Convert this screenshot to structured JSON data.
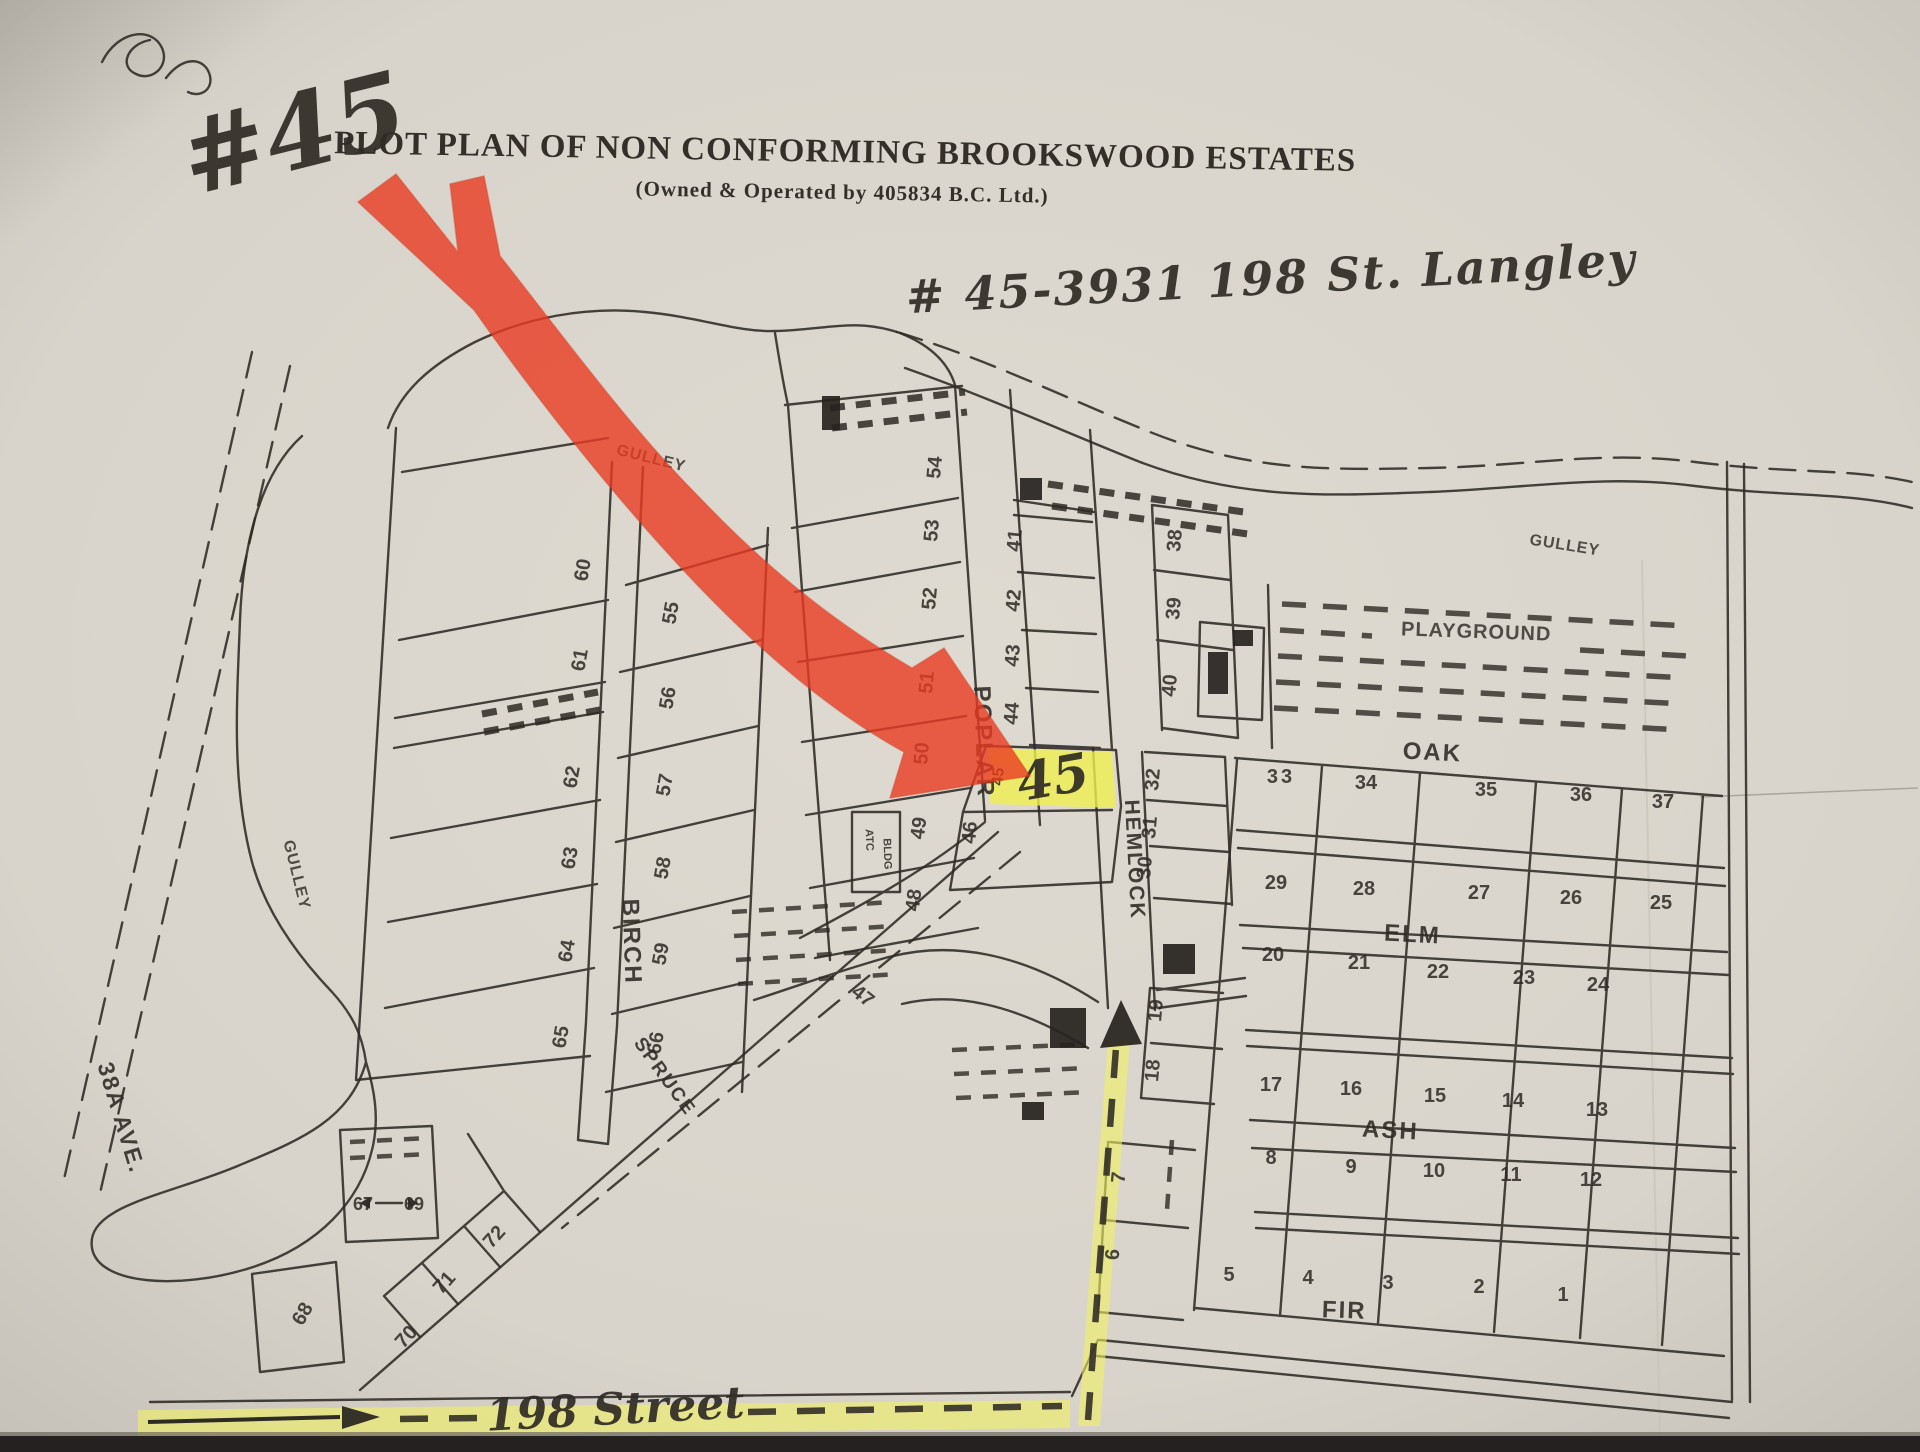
{
  "page": {
    "title": "PLOT PLAN OF NON CONFORMING BROOKSWOOD ESTATES",
    "subtitle": "(Owned & Operated by 405834 B.C. Ltd.)"
  },
  "annotations": {
    "unit": "#45",
    "address": "# 45-3931 198 St. Langley",
    "street_label": "198 Street",
    "lot45_handwritten": "45"
  },
  "colors": {
    "paper": "#d9d5cc",
    "ink": "#2e2a24",
    "highlight_arrow_red": "#ea3b22",
    "highlight_yellow": "#f0ef55"
  },
  "map": {
    "streets": [
      {
        "t": "POPLAR",
        "x": 976,
        "y": 742,
        "r": 88,
        "s": 24
      },
      {
        "t": "HEMLOCK",
        "x": 1128,
        "y": 860,
        "r": 87,
        "s": 21
      },
      {
        "t": "BIRCH",
        "x": 624,
        "y": 942,
        "r": 88,
        "s": 24
      },
      {
        "t": "OAK",
        "x": 1432,
        "y": 760,
        "r": 3,
        "s": 24,
        "ls": 3
      },
      {
        "t": "ELM",
        "x": 1412,
        "y": 942,
        "r": 3,
        "s": 24,
        "ls": 3
      },
      {
        "t": "ASH",
        "x": 1390,
        "y": 1138,
        "r": 3,
        "s": 24,
        "ls": 2
      },
      {
        "t": "FIR",
        "x": 1344,
        "y": 1318,
        "r": 2,
        "s": 24,
        "ls": 2
      },
      {
        "t": "SPRUCE",
        "x": 660,
        "y": 1080,
        "r": 54,
        "s": 19
      },
      {
        "t": "38A AVE.",
        "x": 114,
        "y": 1120,
        "r": 73,
        "s": 23
      }
    ],
    "areas": [
      {
        "t": "GULLEY",
        "x": 650,
        "y": 463,
        "r": 14,
        "s": 16,
        "ls": 2
      },
      {
        "t": "GULLEY",
        "x": 1564,
        "y": 550,
        "r": 9,
        "s": 16,
        "ls": 2
      },
      {
        "t": "GULLEY",
        "x": 292,
        "y": 876,
        "r": 76,
        "s": 16,
        "ls": 2
      },
      {
        "t": "PLAYGROUND",
        "x": 1476,
        "y": 638,
        "r": 2,
        "s": 20,
        "ls": 4
      }
    ],
    "buildings": [
      {
        "t": "ATC",
        "x": 866,
        "y": 840,
        "r": 88,
        "s": 11
      },
      {
        "t": "BLDG",
        "x": 884,
        "y": 854,
        "r": 88,
        "s": 11
      }
    ],
    "lots": [
      {
        "t": "60",
        "x": 589,
        "y": 571,
        "r": -80
      },
      {
        "t": "61",
        "x": 586,
        "y": 661,
        "r": -80
      },
      {
        "t": "62",
        "x": 578,
        "y": 778,
        "r": -80
      },
      {
        "t": "63",
        "x": 576,
        "y": 859,
        "r": -80
      },
      {
        "t": "64",
        "x": 573,
        "y": 952,
        "r": -80
      },
      {
        "t": "65",
        "x": 567,
        "y": 1038,
        "r": -80
      },
      {
        "t": "55",
        "x": 677,
        "y": 614,
        "r": -80
      },
      {
        "t": "56",
        "x": 674,
        "y": 699,
        "r": -80
      },
      {
        "t": "57",
        "x": 671,
        "y": 786,
        "r": -80
      },
      {
        "t": "58",
        "x": 669,
        "y": 869,
        "r": -80
      },
      {
        "t": "59",
        "x": 667,
        "y": 955,
        "r": -80
      },
      {
        "t": "66",
        "x": 662,
        "y": 1044,
        "r": -80
      },
      {
        "t": "54",
        "x": 941,
        "y": 468,
        "r": -85
      },
      {
        "t": "53",
        "x": 938,
        "y": 531,
        "r": -85
      },
      {
        "t": "52",
        "x": 936,
        "y": 599,
        "r": -85
      },
      {
        "t": "51",
        "x": 933,
        "y": 683,
        "r": -85
      },
      {
        "t": "50",
        "x": 928,
        "y": 754,
        "r": -85
      },
      {
        "t": "49",
        "x": 925,
        "y": 829,
        "r": -82
      },
      {
        "t": "48",
        "x": 920,
        "y": 901,
        "r": -82
      },
      {
        "t": "41",
        "x": 1021,
        "y": 541,
        "r": -85
      },
      {
        "t": "42",
        "x": 1020,
        "y": 601,
        "r": -85
      },
      {
        "t": "43",
        "x": 1019,
        "y": 656,
        "r": -85
      },
      {
        "t": "44",
        "x": 1018,
        "y": 714,
        "r": -85
      },
      {
        "t": "45",
        "x": 1003,
        "y": 777,
        "r": -85,
        "s": 16
      },
      {
        "t": "46",
        "x": 976,
        "y": 833,
        "r": -85
      },
      {
        "t": "47",
        "x": 859,
        "y": 1001,
        "r": 38
      },
      {
        "t": "38",
        "x": 1181,
        "y": 541,
        "r": -85
      },
      {
        "t": "39",
        "x": 1180,
        "y": 609,
        "r": -85
      },
      {
        "t": "40",
        "x": 1176,
        "y": 686,
        "r": -85
      },
      {
        "t": "32",
        "x": 1159,
        "y": 780,
        "r": -85
      },
      {
        "t": "31",
        "x": 1156,
        "y": 828,
        "r": -85
      },
      {
        "t": "30",
        "x": 1151,
        "y": 868,
        "r": -85
      },
      {
        "t": "33",
        "x": 1281,
        "y": 783,
        "r": 0,
        "ls": 3
      },
      {
        "t": "34",
        "x": 1366,
        "y": 789,
        "r": 0
      },
      {
        "t": "35",
        "x": 1486,
        "y": 796,
        "r": 0
      },
      {
        "t": "36",
        "x": 1581,
        "y": 801,
        "r": 0
      },
      {
        "t": "37",
        "x": 1663,
        "y": 808,
        "r": 0
      },
      {
        "t": "29",
        "x": 1276,
        "y": 889,
        "r": 0
      },
      {
        "t": "28",
        "x": 1364,
        "y": 895,
        "r": 0
      },
      {
        "t": "27",
        "x": 1479,
        "y": 899,
        "r": 0
      },
      {
        "t": "26",
        "x": 1571,
        "y": 904,
        "r": 0
      },
      {
        "t": "25",
        "x": 1661,
        "y": 909,
        "r": 0
      },
      {
        "t": "20",
        "x": 1273,
        "y": 961,
        "r": 0
      },
      {
        "t": "21",
        "x": 1359,
        "y": 969,
        "r": 0
      },
      {
        "t": "22",
        "x": 1438,
        "y": 978,
        "r": 0
      },
      {
        "t": "23",
        "x": 1524,
        "y": 984,
        "r": 0
      },
      {
        "t": "24",
        "x": 1598,
        "y": 991,
        "r": 0
      },
      {
        "t": "19",
        "x": 1162,
        "y": 1011,
        "r": -85
      },
      {
        "t": "18",
        "x": 1159,
        "y": 1071,
        "r": -85
      },
      {
        "t": "17",
        "x": 1271,
        "y": 1091,
        "r": 0
      },
      {
        "t": "16",
        "x": 1351,
        "y": 1095,
        "r": 0
      },
      {
        "t": "15",
        "x": 1435,
        "y": 1102,
        "r": 0
      },
      {
        "t": "14",
        "x": 1513,
        "y": 1107,
        "r": 0
      },
      {
        "t": "13",
        "x": 1597,
        "y": 1116,
        "r": 0
      },
      {
        "t": "8",
        "x": 1271,
        "y": 1164,
        "r": 0
      },
      {
        "t": "9",
        "x": 1351,
        "y": 1173,
        "r": 0
      },
      {
        "t": "10",
        "x": 1434,
        "y": 1177,
        "r": 0
      },
      {
        "t": "11",
        "x": 1511,
        "y": 1181,
        "r": 0
      },
      {
        "t": "12",
        "x": 1591,
        "y": 1186,
        "r": 0
      },
      {
        "t": "7",
        "x": 1125,
        "y": 1178,
        "r": -85
      },
      {
        "t": "6",
        "x": 1119,
        "y": 1255,
        "r": -85
      },
      {
        "t": "5",
        "x": 1229,
        "y": 1281,
        "r": 0
      },
      {
        "t": "4",
        "x": 1308,
        "y": 1284,
        "r": 0
      },
      {
        "t": "3",
        "x": 1388,
        "y": 1289,
        "r": 0
      },
      {
        "t": "2",
        "x": 1479,
        "y": 1293,
        "r": 0
      },
      {
        "t": "1",
        "x": 1563,
        "y": 1301,
        "r": 0
      },
      {
        "t": "67",
        "x": 363,
        "y": 1210,
        "r": 0,
        "s": 18
      },
      {
        "t": "69",
        "x": 414,
        "y": 1210,
        "r": 0,
        "s": 18
      },
      {
        "t": "68",
        "x": 308,
        "y": 1317,
        "r": -60
      },
      {
        "t": "70",
        "x": 411,
        "y": 1341,
        "r": -48
      },
      {
        "t": "71",
        "x": 449,
        "y": 1287,
        "r": -48
      },
      {
        "t": "72",
        "x": 499,
        "y": 1241,
        "r": -48
      }
    ]
  }
}
